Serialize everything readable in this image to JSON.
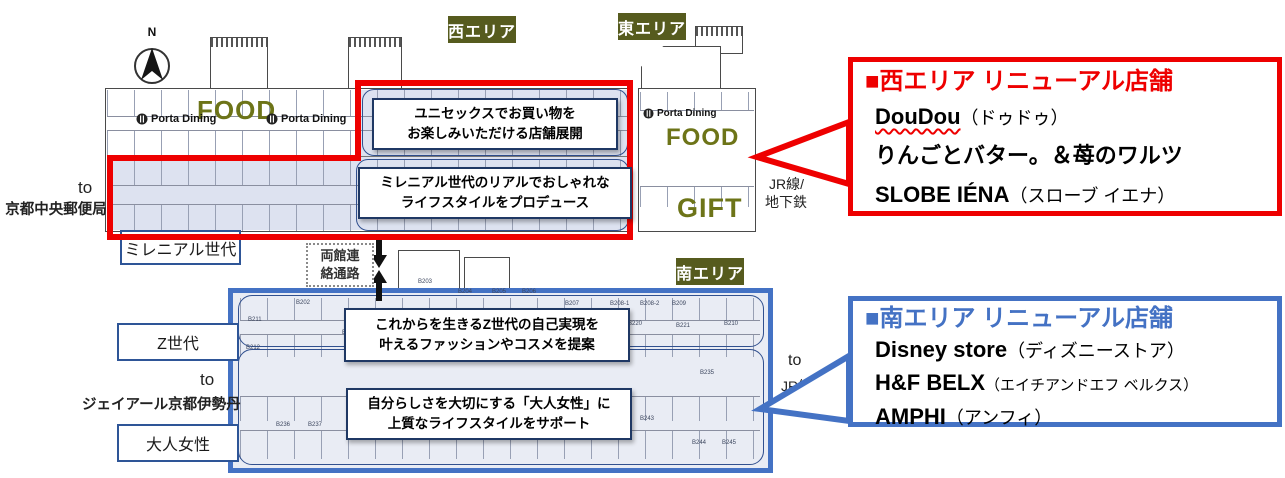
{
  "colors": {
    "red": "#ee0000",
    "blue": "#4472c4",
    "olive_badge": "#565b1e",
    "olive_text": "#6d7418",
    "navy_box_border": "#1f3864"
  },
  "compass": {
    "north": "N"
  },
  "badges": {
    "west": "西エリア",
    "east": "東エリア",
    "south": "南エリア"
  },
  "upper_map": {
    "food_west": "FOOD",
    "porta_dining_west_1": "Porta Dining",
    "porta_dining_west_2": "Porta Dining",
    "porta_dining_east": "Porta Dining",
    "food_east": "FOOD",
    "gift_east": "GIFT",
    "callout_unisex": {
      "line1": "ユニセックスでお買い物を",
      "line2": "お楽しみいただける店舗展開"
    },
    "callout_millennial": {
      "line1": "ミレニアル世代のリアルでおしゃれな",
      "line2": "ライフスタイルをプロデュース"
    }
  },
  "south_map": {
    "callout_genz": {
      "line1": "これからを生きるZ世代の自己実現を",
      "line2": "叶えるファッションやコスメを提案"
    },
    "callout_otona": {
      "line1": "自分らしさを大切にする「大人女性」に",
      "line2": "上質なライフスタイルをサポート"
    },
    "room_labels": [
      "B202",
      "B203",
      "B204",
      "B205",
      "B206",
      "B207",
      "B208-1",
      "B208-2",
      "B209",
      "B210",
      "B211",
      "B212",
      "B213",
      "B220",
      "B221",
      "B235",
      "B236",
      "B237",
      "B242",
      "B243",
      "B244",
      "B245"
    ]
  },
  "corridor": {
    "line1": "両館連",
    "line2": "絡通路"
  },
  "side_labels": {
    "post_office": {
      "to": "to",
      "name": "京都中央郵便局"
    },
    "millennial_tag": "ミレニアル世代",
    "genz_tag": "Z世代",
    "isetan": {
      "to": "to",
      "name": "ジェイアール京都伊勢丹"
    },
    "otona_tag": "大人女性",
    "jr_upper": {
      "to": "to",
      "line1": "JR線/",
      "line2": "地下鉄"
    },
    "jr_lower": {
      "to": "to",
      "line1": "JR線/",
      "line2": "地下鉄"
    }
  },
  "west_panel": {
    "title": "■西エリア リニューアル店舗",
    "stores": [
      {
        "name": "DouDou",
        "reading": "（ドゥドゥ）"
      },
      {
        "name": "りんごとバター。＆苺のワルツ",
        "reading": ""
      },
      {
        "name": "SLOBE IÉNA",
        "reading": "（スローブ イエナ）"
      }
    ]
  },
  "south_panel": {
    "title": "■南エリア リニューアル店舗",
    "stores": [
      {
        "name": "Disney store",
        "reading": "（ディズニーストア）"
      },
      {
        "name": "H&F BELX",
        "reading": "（エイチアンドエフ ベルクス）"
      },
      {
        "name": "AMPHI",
        "reading": "（アンフィ）"
      }
    ]
  }
}
